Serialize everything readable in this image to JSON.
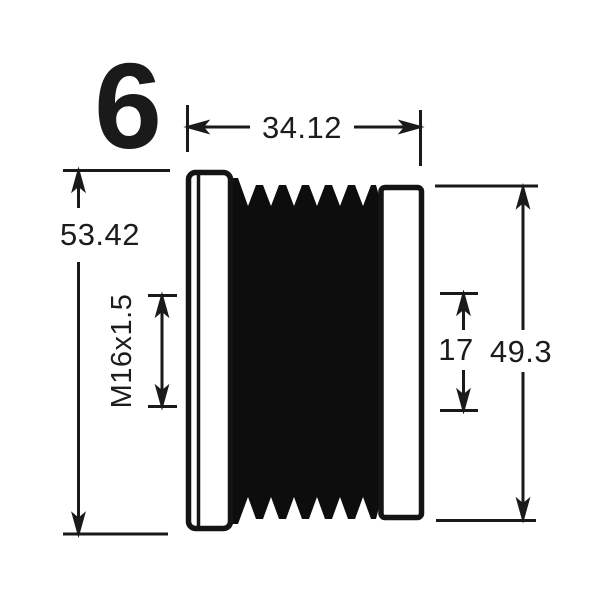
{
  "colors": {
    "background": "#ffffff",
    "line": "#1a1a1a",
    "part_fill": "#0d0d0d",
    "text": "#1c1c1c"
  },
  "drawing": {
    "groove_count": "6",
    "dimensions": {
      "overall_width": "34.12",
      "overall_height": "53.42",
      "thread_spec": "M16x1.5",
      "center_span": "17",
      "right_height": "49.3"
    }
  }
}
